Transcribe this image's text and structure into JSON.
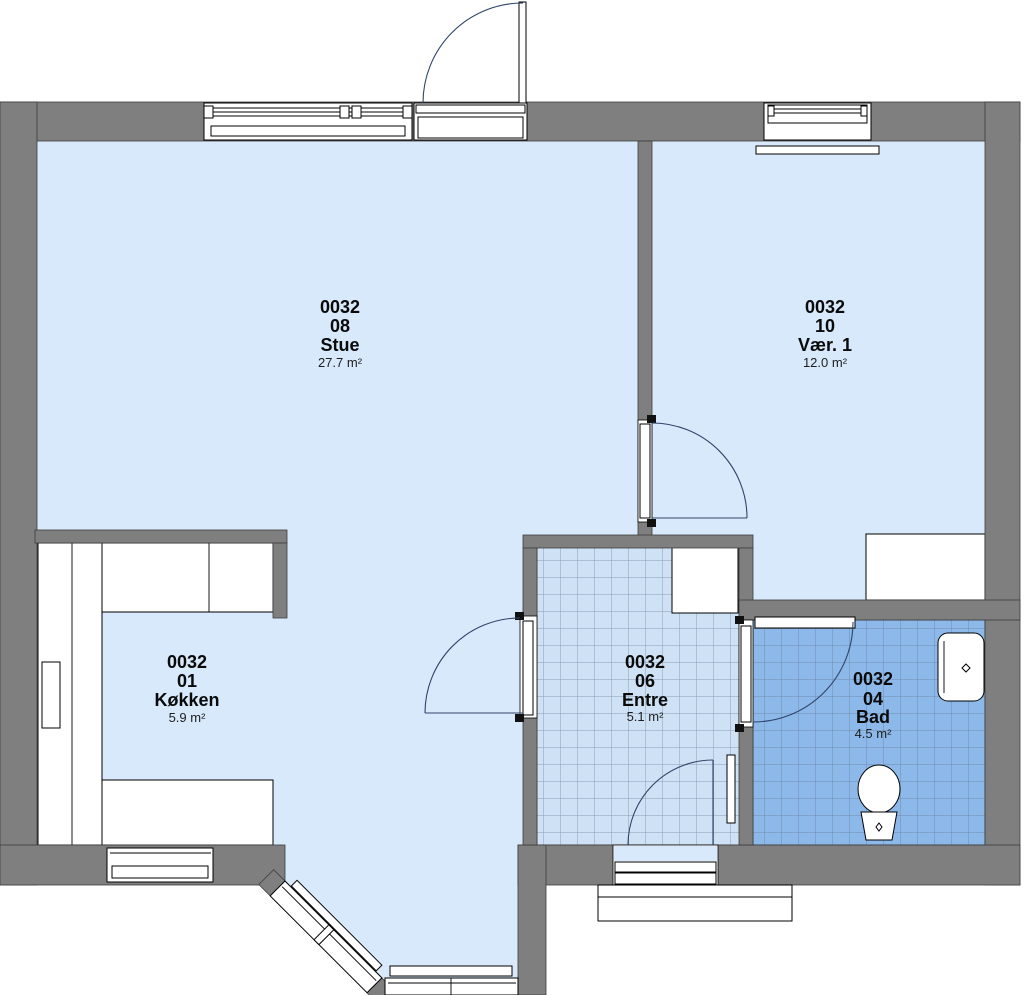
{
  "rooms": [
    {
      "id": "0032",
      "number": "08",
      "name": "Stue",
      "area": "27.7 m²"
    },
    {
      "id": "0032",
      "number": "10",
      "name": "Vær. 1",
      "area": "12.0 m²"
    },
    {
      "id": "0032",
      "number": "01",
      "name": "Køkken",
      "area": "5.9 m²"
    },
    {
      "id": "0032",
      "number": "06",
      "name": "Entre",
      "area": "5.1 m²"
    },
    {
      "id": "0032",
      "number": "04",
      "name": "Bad",
      "area": "4.5 m²"
    }
  ],
  "colors": {
    "wall": "#7f7f7f",
    "floor": "#d8e9fb",
    "tile_entre": "#cfe2f5",
    "tile_entre_grid": "#8a9cb5",
    "tile_bad": "#8db9ea",
    "tile_bad_grid": "#6f8cad",
    "fixture": "#ffffff",
    "background": "#ffffff"
  }
}
